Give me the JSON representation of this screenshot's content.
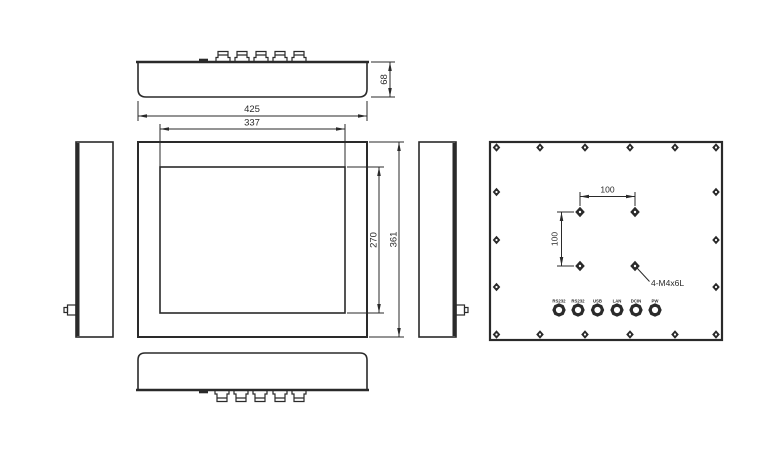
{
  "colors": {
    "line": "#2a2a2a",
    "background": "#ffffff"
  },
  "dimensions": {
    "depth": "68",
    "overall_width": "425",
    "display_width": "337",
    "display_height": "270",
    "overall_height": "361",
    "vesa_spacing_h": "100",
    "vesa_spacing_v": "100",
    "mounting_screw_spec": "4-M4x6L"
  },
  "connector_labels": [
    "RS232",
    "RS232",
    "USB",
    "LAN",
    "DCIN",
    "PW"
  ]
}
